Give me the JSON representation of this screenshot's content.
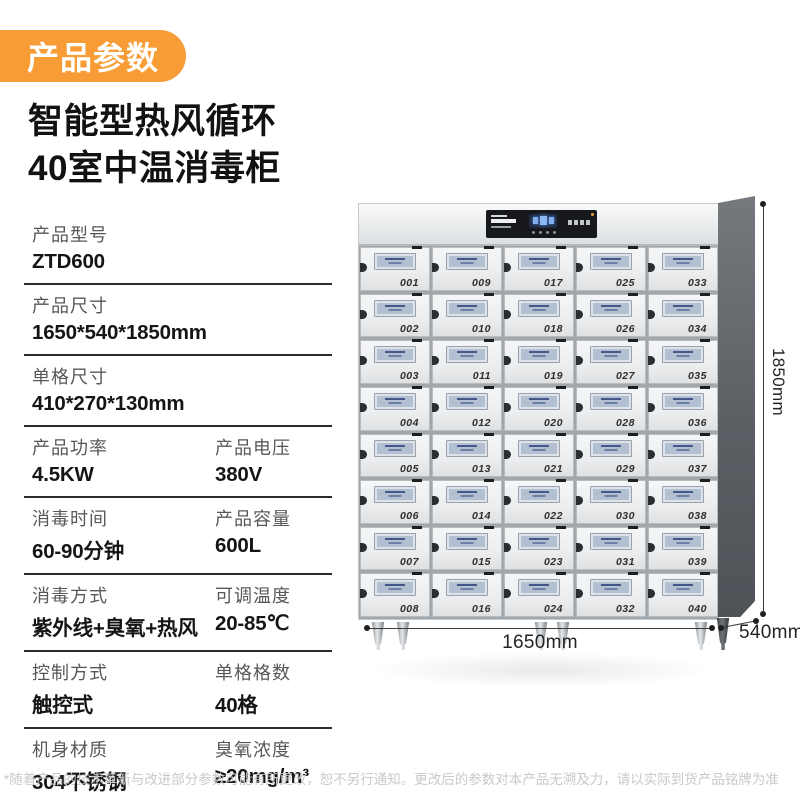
{
  "badge": {
    "label": "产品参数"
  },
  "title": {
    "line1": "智能型热风循环",
    "line2": "40室中温消毒柜"
  },
  "specs": {
    "rows": [
      {
        "cells": [
          {
            "label": "产品型号",
            "value": "ZTD600"
          }
        ]
      },
      {
        "cells": [
          {
            "label": "产品尺寸",
            "value": "1650*540*1850mm"
          }
        ]
      },
      {
        "cells": [
          {
            "label": "单格尺寸",
            "value": "410*270*130mm"
          }
        ]
      },
      {
        "cells": [
          {
            "label": "产品功率",
            "value": "4.5KW"
          },
          {
            "label": "产品电压",
            "value": "380V"
          }
        ]
      },
      {
        "cells": [
          {
            "label": "消毒时间",
            "value": "60-90分钟"
          },
          {
            "label": "产品容量",
            "value": "600L"
          }
        ]
      },
      {
        "cells": [
          {
            "label": "消毒方式",
            "value": "紫外线+臭氧+热风"
          },
          {
            "label": "可调温度",
            "value": "20-85℃"
          }
        ]
      },
      {
        "cells": [
          {
            "label": "控制方式",
            "value": "触控式"
          },
          {
            "label": "单格格数",
            "value": "40格"
          }
        ]
      },
      {
        "cells": [
          {
            "label": "机身材质",
            "value": "304不锈钢"
          },
          {
            "label": "臭氧浓度",
            "value": "≥20mg/m³"
          }
        ]
      }
    ]
  },
  "cabinet": {
    "door_rows": [
      [
        "001",
        "009",
        "017",
        "025",
        "033"
      ],
      [
        "002",
        "010",
        "018",
        "026",
        "034"
      ],
      [
        "003",
        "011",
        "019",
        "027",
        "035"
      ],
      [
        "004",
        "012",
        "020",
        "028",
        "036"
      ],
      [
        "005",
        "013",
        "021",
        "029",
        "037"
      ],
      [
        "006",
        "014",
        "022",
        "030",
        "038"
      ],
      [
        "007",
        "015",
        "023",
        "031",
        "039"
      ],
      [
        "008",
        "016",
        "024",
        "032",
        "040"
      ]
    ]
  },
  "dimensions": {
    "height": "1850mm",
    "width": "1650mm",
    "depth": "540mm"
  },
  "footnote": "*随着产品的技术革新与改进部分参数可能有所更改，恕不另行通知。更改后的参数对本产品无溯及力，请以实际到货产品铭牌为准",
  "colors": {
    "accent": "#F89C35",
    "line": "#2b2b2b",
    "door_window": "#b3c0d1"
  }
}
